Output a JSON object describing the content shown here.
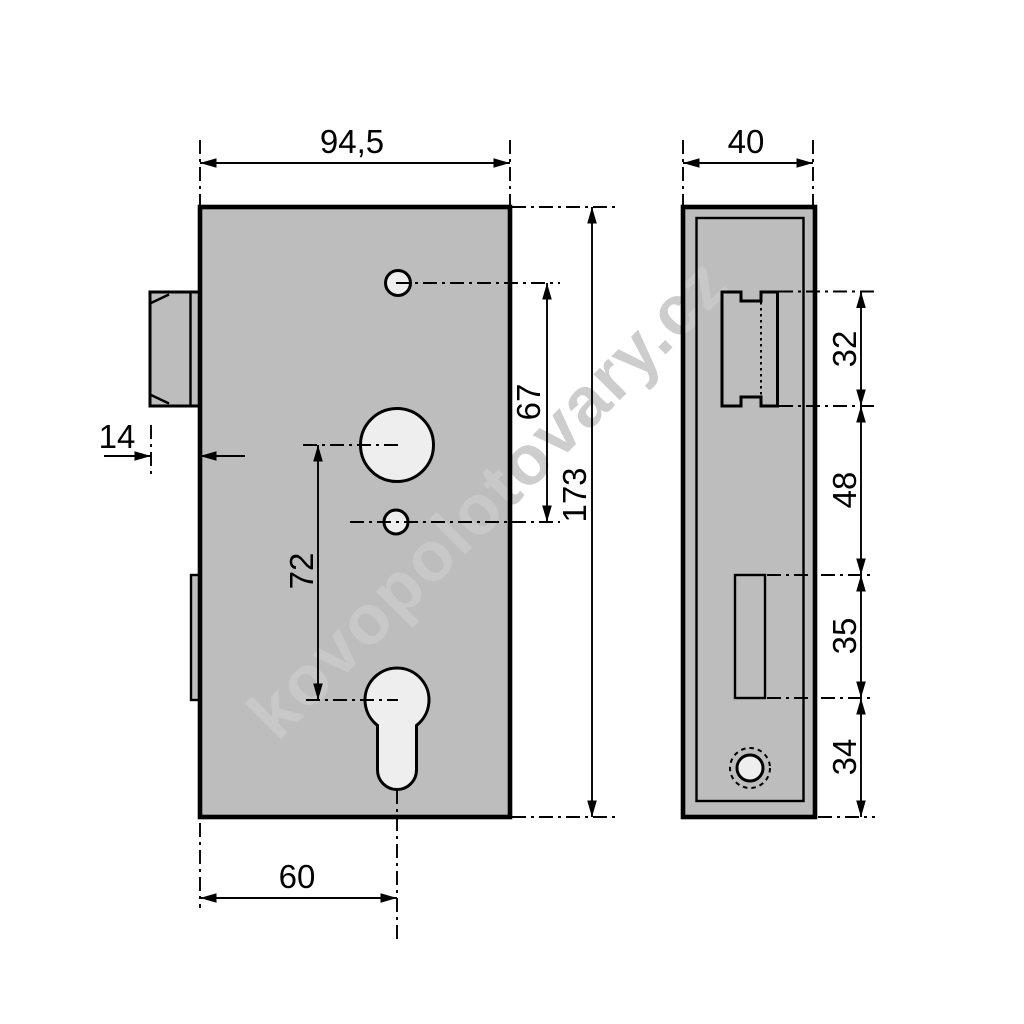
{
  "watermark": {
    "text": "kovopolotovary.cz"
  },
  "front_view": {
    "overall_width": "94,5",
    "overall_height": "173",
    "bolt_protrusion": "14",
    "hole_spacing": "67",
    "follower_to_cylinder": "72",
    "backset": "60"
  },
  "side_view": {
    "depth": "40",
    "bolt_height": "32",
    "bolt_to_slot": "48",
    "slot_height": "35",
    "slot_to_bottom": "34"
  },
  "colors": {
    "background": "#ffffff",
    "body_fill": "#bdbdbd",
    "line": "#000000",
    "watermark": "#c9c9c9"
  }
}
